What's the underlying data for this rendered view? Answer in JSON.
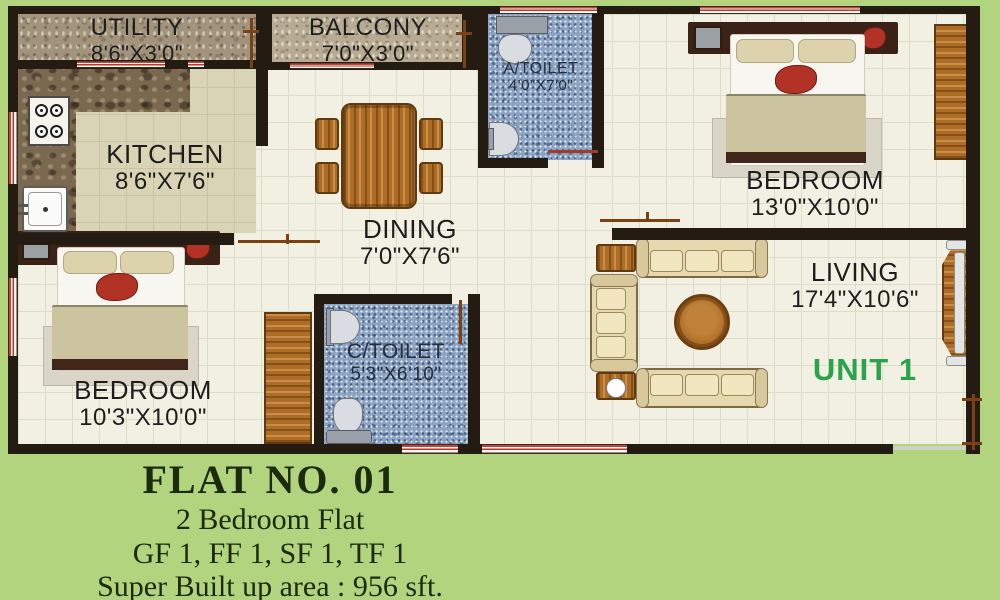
{
  "rooms": {
    "utility": {
      "name": "UTILITY",
      "dims": "8'6\"X3'0\""
    },
    "balcony": {
      "name": "BALCONY",
      "dims": "7'0\"X3'0\""
    },
    "atoilet": {
      "name": "A/TOILET",
      "dims": "4'0\"X7'0\""
    },
    "kitchen": {
      "name": "KITCHEN",
      "dims": "8'6\"X7'6\""
    },
    "dining": {
      "name": "DINING",
      "dims": "7'0\"X7'6\""
    },
    "bedroom1": {
      "name": "BEDROOM",
      "dims": "13'0\"X10'0\""
    },
    "living": {
      "name": "LIVING",
      "dims": "17'4\"X10'6\""
    },
    "ctoilet": {
      "name": "C/TOILET",
      "dims": "5'3\"X6'10\""
    },
    "bedroom2": {
      "name": "BEDROOM",
      "dims": "10'3\"X10'0\""
    }
  },
  "unit_label": "UNIT 1",
  "footer": {
    "flat_no": "FLAT NO. 01",
    "type": "2 Bedroom Flat",
    "floors": "GF 1, FF 1, SF 1, TF 1",
    "area": "Super Built up area : 956 sft."
  },
  "colors": {
    "background_green": "#b3d47e",
    "wall": "#241b12",
    "unit_accent": "#2aa34c",
    "toilet_floor": "#8ba4c3",
    "wood": "#ad6d26",
    "window_red": "#b23b2e",
    "tile_floor": "#f1f0e3",
    "kitchen_floor": "#d9d4b6"
  }
}
